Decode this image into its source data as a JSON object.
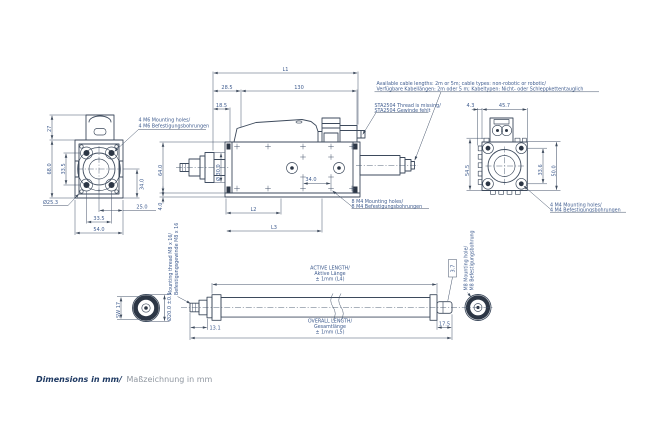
{
  "title": {
    "en": "Dimensions in mm/",
    "de": "Maßzeichnung in mm"
  },
  "notes": {
    "cable_en": "Available cable lengths: 2m or 5m; cable types: non-robotic or robotic/",
    "cable_de": "Verfügbare Kabellängen: 2m oder 5 m; Kabeltypen: Nicht- oder Schleppkettentauglich",
    "sta_en": "STA2504 Thread is missing/",
    "sta_de": "STA2504 Gewinde fehlt"
  },
  "labels": {
    "m6_en": "4 M6 Mounting holes/",
    "m6_de": "4 M6 Befestigungsbohrungen",
    "m4_8_en": "8 M4 Mounting holes/",
    "m4_8_de": "8 M4 Befestigungsbohrungen",
    "m4_4_en": "4 M4 Mounting holes/",
    "m4_4_de": "4 M4 Befestigungsbohrungen",
    "thread_en": "Mounting thread M8 x 16/",
    "thread_de": "Befestigungsgewinde M8 x 16",
    "m8_hole_en": "M8 Mounting hole/",
    "m8_hole_de": "M8 Befestigungsbohrung",
    "active_en": "ACTIVE LENGTH/",
    "active_de": "Aktive Länge",
    "active_tol": "± 1mm (L4)",
    "overall_en": "OVERALL LENGTH/",
    "overall_de": "Gesamtlänge",
    "overall_tol": "± 1mm (L5)"
  },
  "dims": {
    "front": {
      "motor_height": "27",
      "height": "68.0",
      "hole_spacing_v": "33.5",
      "side": "34.0",
      "offset": "25.0",
      "hole_spacing_h": "33.5",
      "width": "54.0",
      "bore": "Ø25.3"
    },
    "side": {
      "overall": "L1",
      "front_len": "28.5",
      "body_len": "130",
      "flange_len": "18.5",
      "height": "64.0",
      "rod_dia": "Ø 30.0",
      "plate": "4.0",
      "hole_spacing": "34.0",
      "l2": "L2",
      "l3": "L3"
    },
    "rear": {
      "fin": "4.3",
      "width": "45.7",
      "height": "54.5",
      "hole_spacing": "33.6",
      "outer": "50.0"
    },
    "tube": {
      "wrench": "SW 17",
      "dia": "Ø20.0 ±0.1",
      "tip_len": "13.1",
      "end_len": "17.5",
      "end_dia": "3.7"
    }
  },
  "colors": {
    "line": "#3d4a5c",
    "dim_text": "#3f5c8f",
    "title": "#1f3a63",
    "muted_title": "#9097a0",
    "dark_fill": "#2c3645",
    "background": "#ffffff"
  }
}
